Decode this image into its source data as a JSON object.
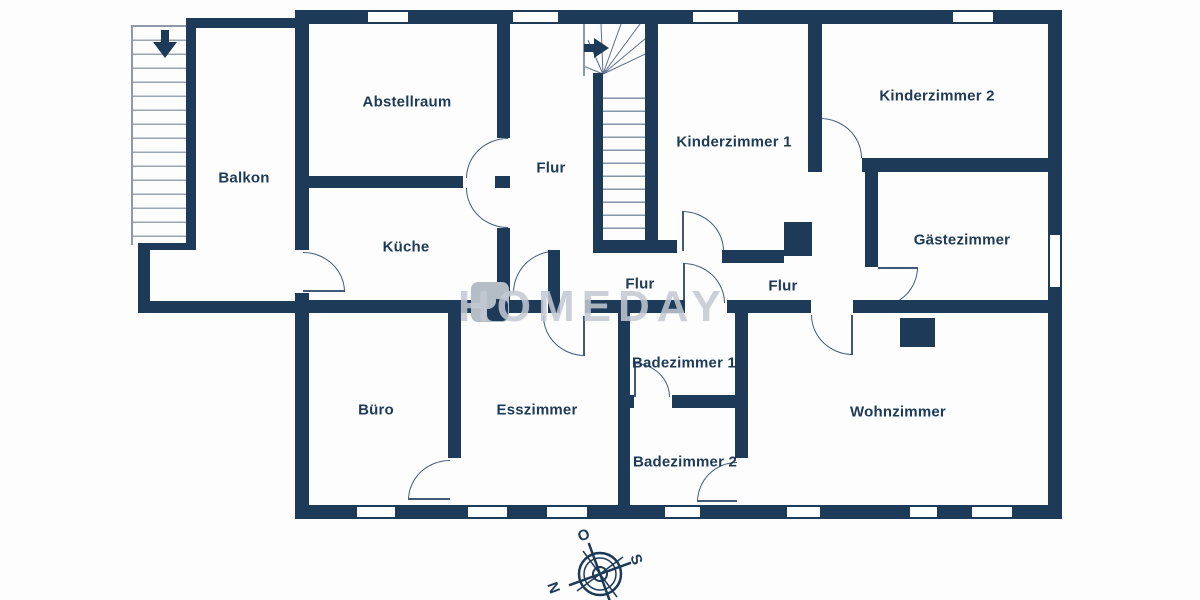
{
  "plan": {
    "watermark": "HOMEDAY",
    "rooms": [
      {
        "id": "balkon",
        "label": "Balkon"
      },
      {
        "id": "abstellraum",
        "label": "Abstellraum"
      },
      {
        "id": "flur-west",
        "label": "Flur"
      },
      {
        "id": "kinderzimmer-1",
        "label": "Kinderzimmer 1"
      },
      {
        "id": "kinderzimmer-2",
        "label": "Kinderzimmer 2"
      },
      {
        "id": "kueche",
        "label": "Küche"
      },
      {
        "id": "gaestezimmer",
        "label": "Gästezimmer"
      },
      {
        "id": "flur-mitte",
        "label": "Flur"
      },
      {
        "id": "flur-ost",
        "label": "Flur"
      },
      {
        "id": "buero",
        "label": "Büro"
      },
      {
        "id": "esszimmer",
        "label": "Esszimmer"
      },
      {
        "id": "badezimmer-1",
        "label": "Badezimmer 1"
      },
      {
        "id": "badezimmer-2",
        "label": "Badezimmer 2"
      },
      {
        "id": "wohnzimmer",
        "label": "Wohnzimmer"
      }
    ],
    "compass": {
      "north": "N",
      "east": "O",
      "south": "S"
    },
    "colors": {
      "wall": "#1e3a59",
      "text": "#1d3a57",
      "watermark": "#c3c9d2",
      "chimney": "#b4bcc6"
    }
  }
}
